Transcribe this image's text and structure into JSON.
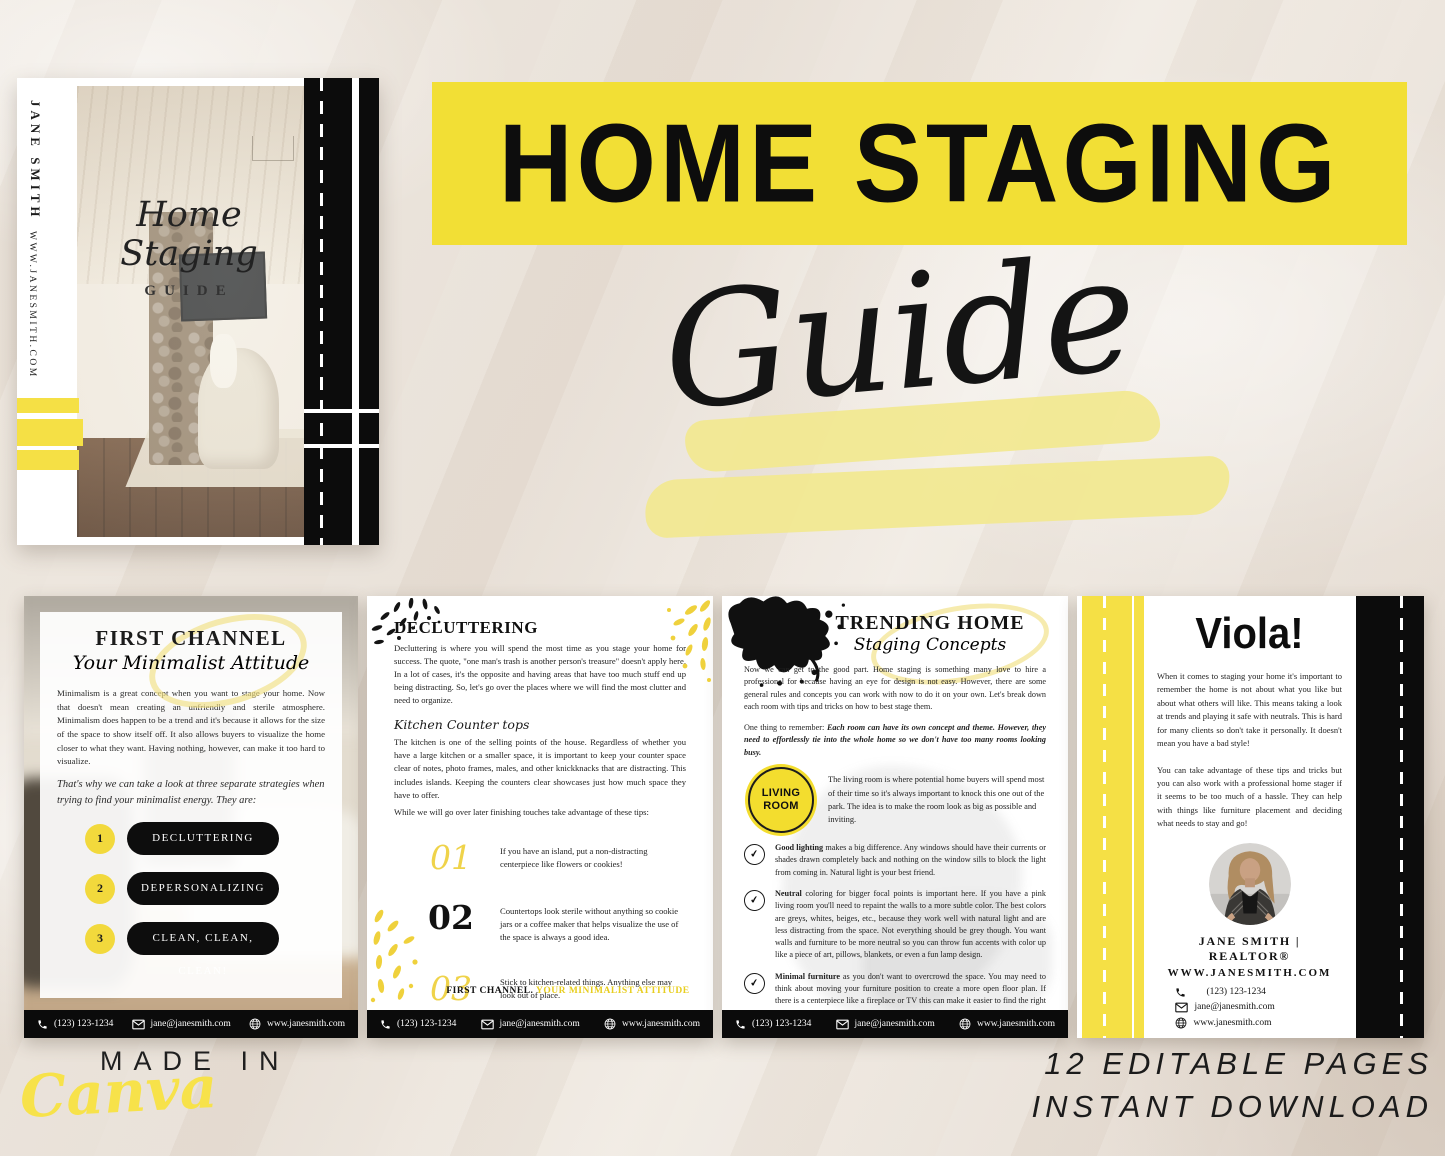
{
  "colors": {
    "accent_yellow": "#F2DF35",
    "cover_yellow": "#F5E045",
    "brush_yellow": "#F2E88F",
    "black": "#0D0D0D"
  },
  "hero": {
    "title": "HOME STAGING",
    "subtitle": "Guide"
  },
  "cover": {
    "author": "JANE SMITH",
    "website": "WWW.JANESMITH.COM",
    "script_title": "Home Staging",
    "caps_title": "GUIDE"
  },
  "made_in": {
    "label": "MADE IN",
    "brand": "Canva"
  },
  "promo": {
    "line1": "12 EDITABLE PAGES",
    "line2": "INSTANT DOWNLOAD"
  },
  "contact": {
    "phone": "(123) 123-1234",
    "email": "jane@janesmith.com",
    "website": "www.janesmith.com"
  },
  "icons": {
    "check": "✔"
  },
  "page1": {
    "title": "FIRST CHANNEL",
    "subtitle": "Your Minimalist Attitude",
    "para1": "Minimalism is a great concept when you want to stage your home. Now that doesn't mean creating an unfriendly and sterile atmosphere. Minimalism does happen to be a trend and it's because it allows for the size of the space to show itself off. It also allows buyers to visualize the home closer to what they want. Having nothing, however, can make it too hard to visualize.",
    "para2": "That's why we can take a look at three separate strategies when trying to find your minimalist energy. They are:",
    "items": [
      {
        "num": "1",
        "label": "DECLUTTERING"
      },
      {
        "num": "2",
        "label": "DEPERSONALIZING"
      },
      {
        "num": "3",
        "label": "CLEAN, CLEAN, CLEAN!"
      }
    ]
  },
  "page2": {
    "heading": "DECLUTTERING",
    "para1": "Decluttering is where you will spend the most time as you stage your home for success. The quote, \"one man's trash is another person's treasure\" doesn't apply here. In a lot of cases, it's the opposite and having areas that have too much stuff end up being distracting. So, let's go over the places where we will find the most clutter and need to organize.",
    "subheading": "Kitchen Counter tops",
    "para2": "The kitchen is one of the selling points of the house. Regardless of whether you have a large kitchen or a smaller space, it is important to keep your counter space clear of notes, photo frames, males, and other knickknacks that are distracting. This includes islands. Keeping the counters clear showcases just how much space they have to offer.",
    "para3": "While we will go over later finishing touches take advantage of these tips:",
    "tips": [
      {
        "num": "01",
        "text": "If you have an island, put a non-distracting centerpiece like flowers or cookies!"
      },
      {
        "num": "02",
        "text": "Countertops look sterile without anything so cookie jars or a coffee maker that helps visualize the use of the space is always a good idea."
      },
      {
        "num": "03",
        "text": "Stick to kitchen-related things. Anything else may look out of place."
      }
    ],
    "note_black": "FIRST CHANNEL.",
    "note_yellow": "YOUR MINIMALIST ATTITUDE"
  },
  "page3": {
    "title": "TRENDING HOME",
    "subtitle": "Staging Concepts",
    "para1": "Now we can get to the good part. Home staging is something many love to hire a professional for because having an eye for design is not easy. However, there are some general rules and concepts you can work with now to do it on your own. Let's break down each room with tips and tricks on how to best stage them.",
    "para2_lead": "One thing to remember: ",
    "para2_em": "Each room can have its own concept and theme. However, they need to effortlessly tie into the whole home so we don't have too many rooms looking busy.",
    "badge_line1": "LIVING",
    "badge_line2": "ROOM",
    "intro": "The living room is where potential home buyers will spend most of their time so it's always important to knock this one out of the park. The idea is to make the room look as big as possible and inviting.",
    "bullets": [
      {
        "lead": "Good lighting",
        "text": " makes a big difference. Any windows should have their currents or shades drawn completely back and nothing on the window sills to block the light from coming in. Natural light is your best friend."
      },
      {
        "lead": "Neutral",
        "text": " coloring for bigger focal points is important here. If you have a pink living room you'll need to repaint the walls to a more subtle color. The best colors are greys, whites, beiges, etc., because they work well with natural light and are less distracting from the space. Not everything should be grey though. You want walls and furniture to be more neutral so you can throw fun accents with color up like a piece of art, pillows, blankets, or even a fun lamp design."
      },
      {
        "lead": "Minimal furniture",
        "text": " as you don't want to overcrowd the space. You may need to think about moving your furniture position to create a more open floor plan. If there is a centerpiece like a fireplace or TV this can make it easier to find the right positioning."
      }
    ]
  },
  "page4": {
    "title": "Viola!",
    "para1": "When it comes to staging your home it's important to remember the home is not about what you like but about what others will like. This means taking a look at trends and playing it safe with neutrals. This is hard for many clients so don't take it personally. It doesn't mean you have a bad style!",
    "para2": "You can take advantage of these tips and tricks but you can also work with a professional home stager if it seems to be too much of a hassle. They can help with things like furniture placement and deciding what needs to stay and go!",
    "name": "JANE SMITH | REALTOR®",
    "site": "WWW.JANESMITH.COM"
  }
}
